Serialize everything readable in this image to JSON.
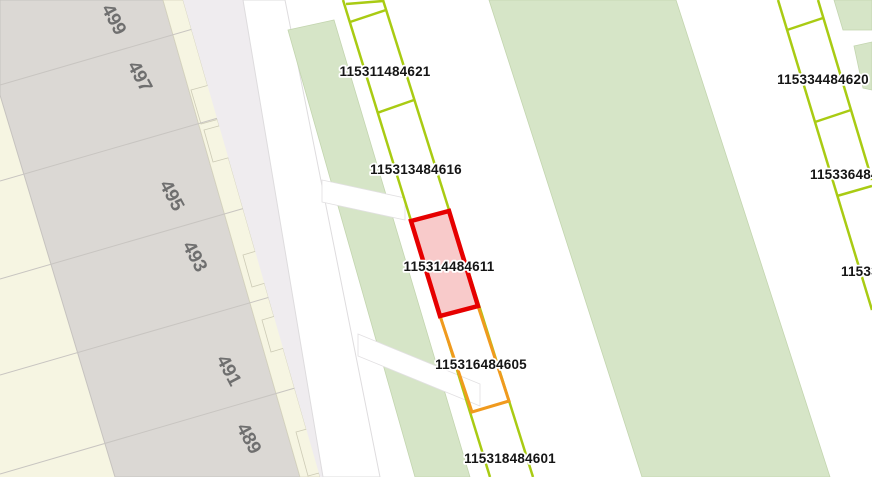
{
  "map": {
    "kind": "cadastral-parcel-map",
    "selected_parcel_id": "115314484611"
  },
  "parcels": {
    "labels": [
      {
        "text": "115311484621"
      },
      {
        "text": "115313484616"
      },
      {
        "text": "115314484611"
      },
      {
        "text": "115316484605"
      },
      {
        "text": "115318484601"
      },
      {
        "text": "115334484620"
      },
      {
        "text": "115336484"
      },
      {
        "text": "11533"
      }
    ]
  },
  "houses": {
    "numbers": [
      {
        "text": "499"
      },
      {
        "text": "497"
      },
      {
        "text": "495"
      },
      {
        "text": "493"
      },
      {
        "text": "491"
      },
      {
        "text": "489"
      }
    ]
  },
  "colors": {
    "parcel_line": "#a9cb13",
    "selected_stroke": "#e60000",
    "selected_fill": "#f8caca",
    "pending_stroke": "#f09a1e",
    "greenspace": "#d6e5c7",
    "greenspace_edge": "#c3d5af",
    "building": "#dbd8d4",
    "building_edge": "#c6c3bf",
    "garden": "#f6f5e2",
    "garden_edge": "#d5d3bd",
    "road_white": "#ffffff",
    "road_secondary": "#efecef",
    "road_edge": "#dedcde",
    "label_text": "#151515",
    "house_number_text": "#6f6f6f"
  }
}
